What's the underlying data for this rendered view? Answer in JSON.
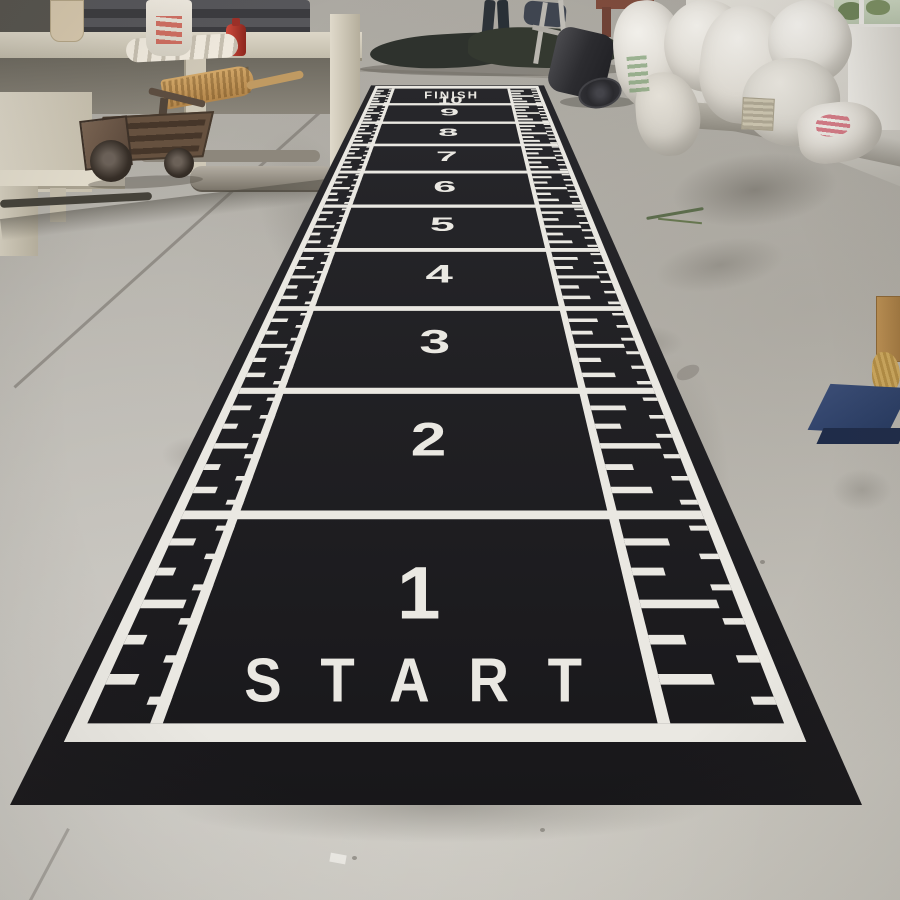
{
  "scene": {
    "description": "Black sprint-track gym mat with white ruler markings laid out on the concrete floor of a carpet factory warehouse",
    "setting": "warehouse interior, daylight"
  },
  "mat": {
    "finish_label": "FINISH",
    "finish_number": "10",
    "start_label": "START",
    "section_numbers": [
      "1",
      "2",
      "3",
      "4",
      "5",
      "6",
      "7",
      "8",
      "9"
    ],
    "colors": {
      "base": "#18171a",
      "base_far": "#27272b",
      "marking": "#eae8e2"
    }
  },
  "environment": {
    "floor_color": "#bcb9b2",
    "objects": [
      {
        "name": "fabric-roll-stack",
        "color": "#47474b"
      },
      {
        "name": "factory-machine",
        "color": "#d3ccbb"
      },
      {
        "name": "fire-extinguisher",
        "color": "#b43a30"
      },
      {
        "name": "paper-pouch",
        "color": "#d8c9ae"
      },
      {
        "name": "white-tubes",
        "color": "#e8e3d7"
      },
      {
        "name": "printed-sack",
        "color": "#e5e0d5"
      },
      {
        "name": "broom",
        "color": "#c79a57"
      },
      {
        "name": "hand-cart",
        "color": "#5a4a3d"
      },
      {
        "name": "worker-legs",
        "color": "#2c3136"
      },
      {
        "name": "dark-tarp",
        "color": "#30342f"
      },
      {
        "name": "chair-frame",
        "color": "#b7b5ae"
      },
      {
        "name": "wooden-table-frame",
        "color": "#7e4b3c"
      },
      {
        "name": "rolled-black-carpet",
        "color": "#2a2a2e"
      },
      {
        "name": "gray-fabric-roll",
        "color": "#a5a198"
      },
      {
        "name": "white-sacks-pile",
        "color": "#e6e4df"
      },
      {
        "name": "warehouse-wall",
        "color": "#d9d6cf"
      },
      {
        "name": "window-with-greenery",
        "color": "#7c9163"
      },
      {
        "name": "cardboard-box",
        "color": "#b08549"
      },
      {
        "name": "blue-platform-dolly",
        "color": "#2e4068"
      },
      {
        "name": "concrete-joint-lines",
        "color": "#8f8c85"
      }
    ]
  }
}
